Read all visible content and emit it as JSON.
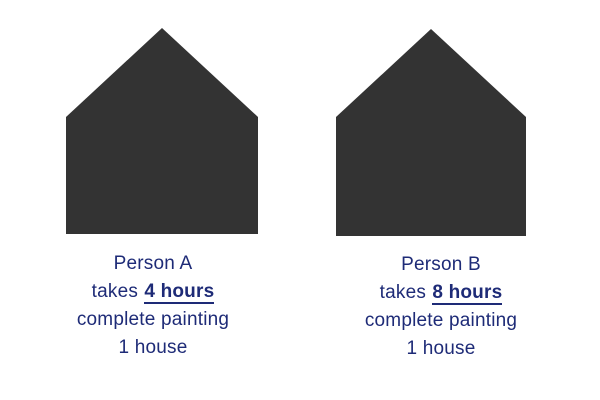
{
  "colors": {
    "house": "#333333",
    "ink": "#1e2b77",
    "background": "#ffffff"
  },
  "figures": [
    {
      "name": "Person A",
      "takes_prefix": "takes",
      "duration": "4 hours",
      "task_line": "complete painting",
      "quantity_line": "1 house"
    },
    {
      "name": "Person B",
      "takes_prefix": "takes",
      "duration": "8 hours",
      "task_line": "complete painting",
      "quantity_line": "1 house"
    }
  ]
}
